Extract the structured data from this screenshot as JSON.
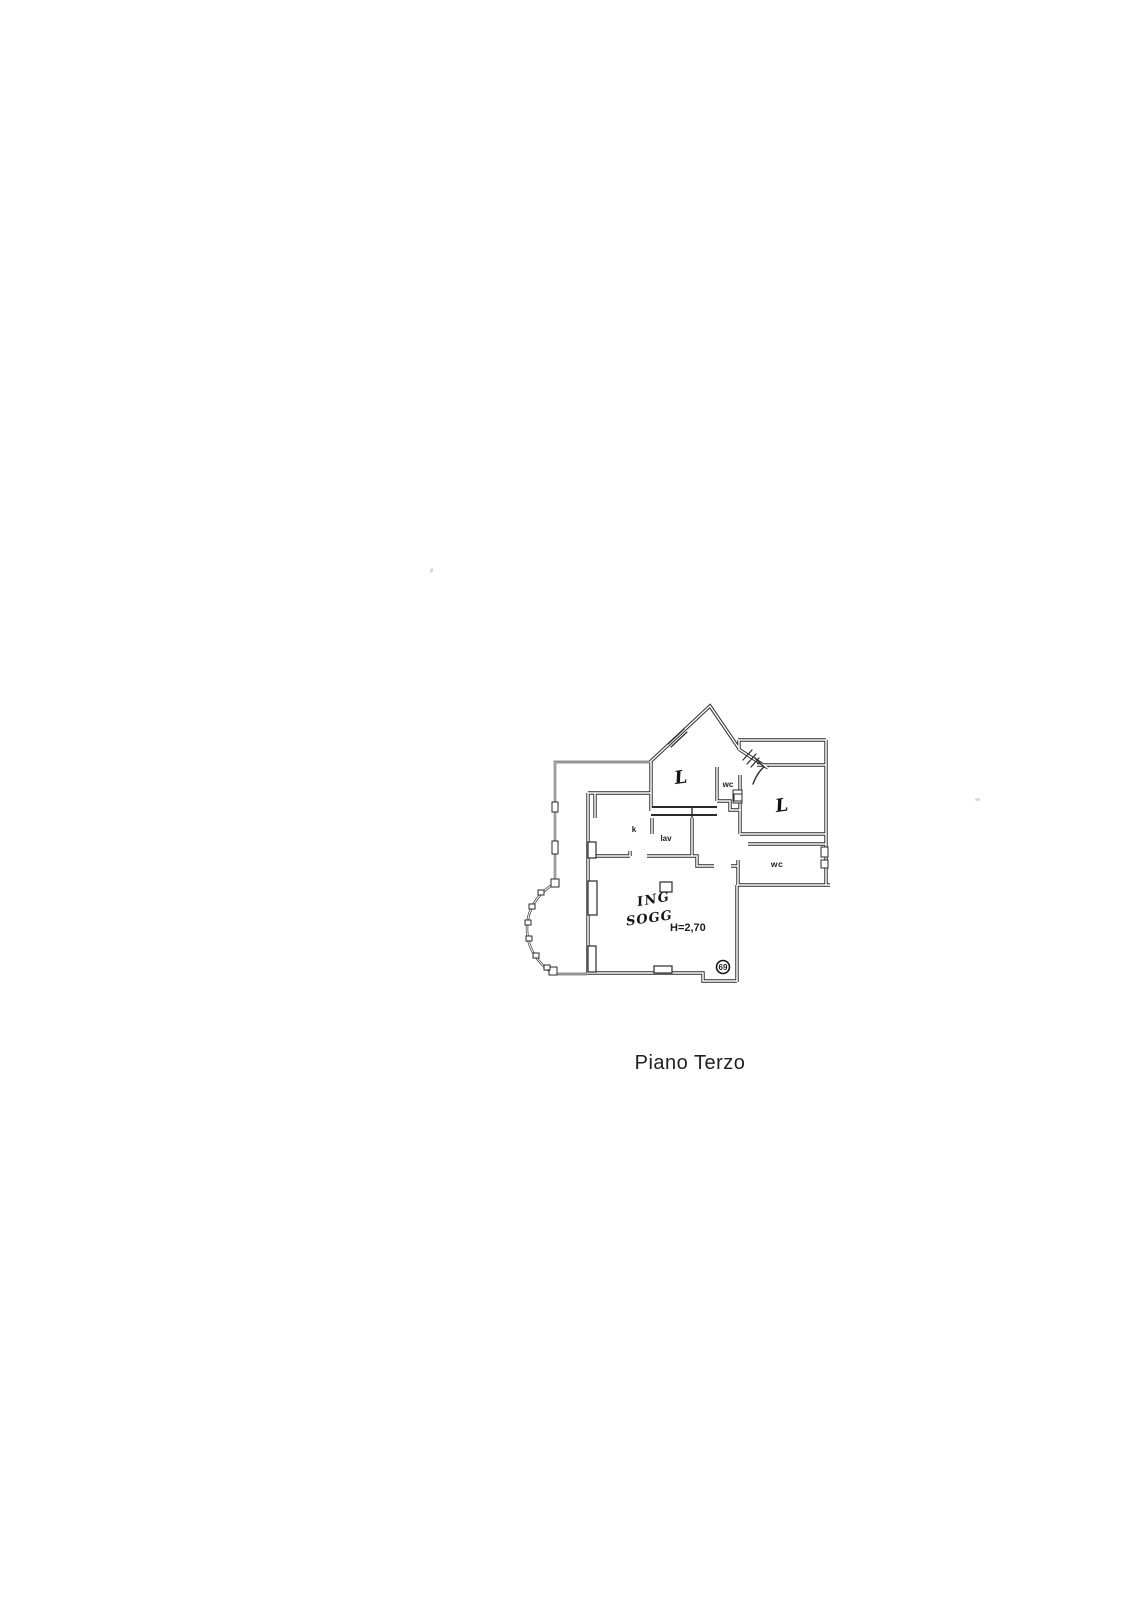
{
  "page": {
    "caption": "Piano Terzo"
  },
  "colors": {
    "paper": "#ffffff",
    "ink": "#2a2a2a",
    "handwriting": "#141414"
  },
  "floor_plan": {
    "kind": "scanned apartment floor plan, third floor",
    "labels": {
      "bedroom_top": "L",
      "wc_top": "wc",
      "bedroom_right": "L",
      "kitchen": "k",
      "laundry": "lav",
      "wc_bottom": "wc",
      "living_line1": "ING",
      "living_line2": "SOGG",
      "height_note": "H=2,70",
      "stamp_number": "69"
    }
  }
}
